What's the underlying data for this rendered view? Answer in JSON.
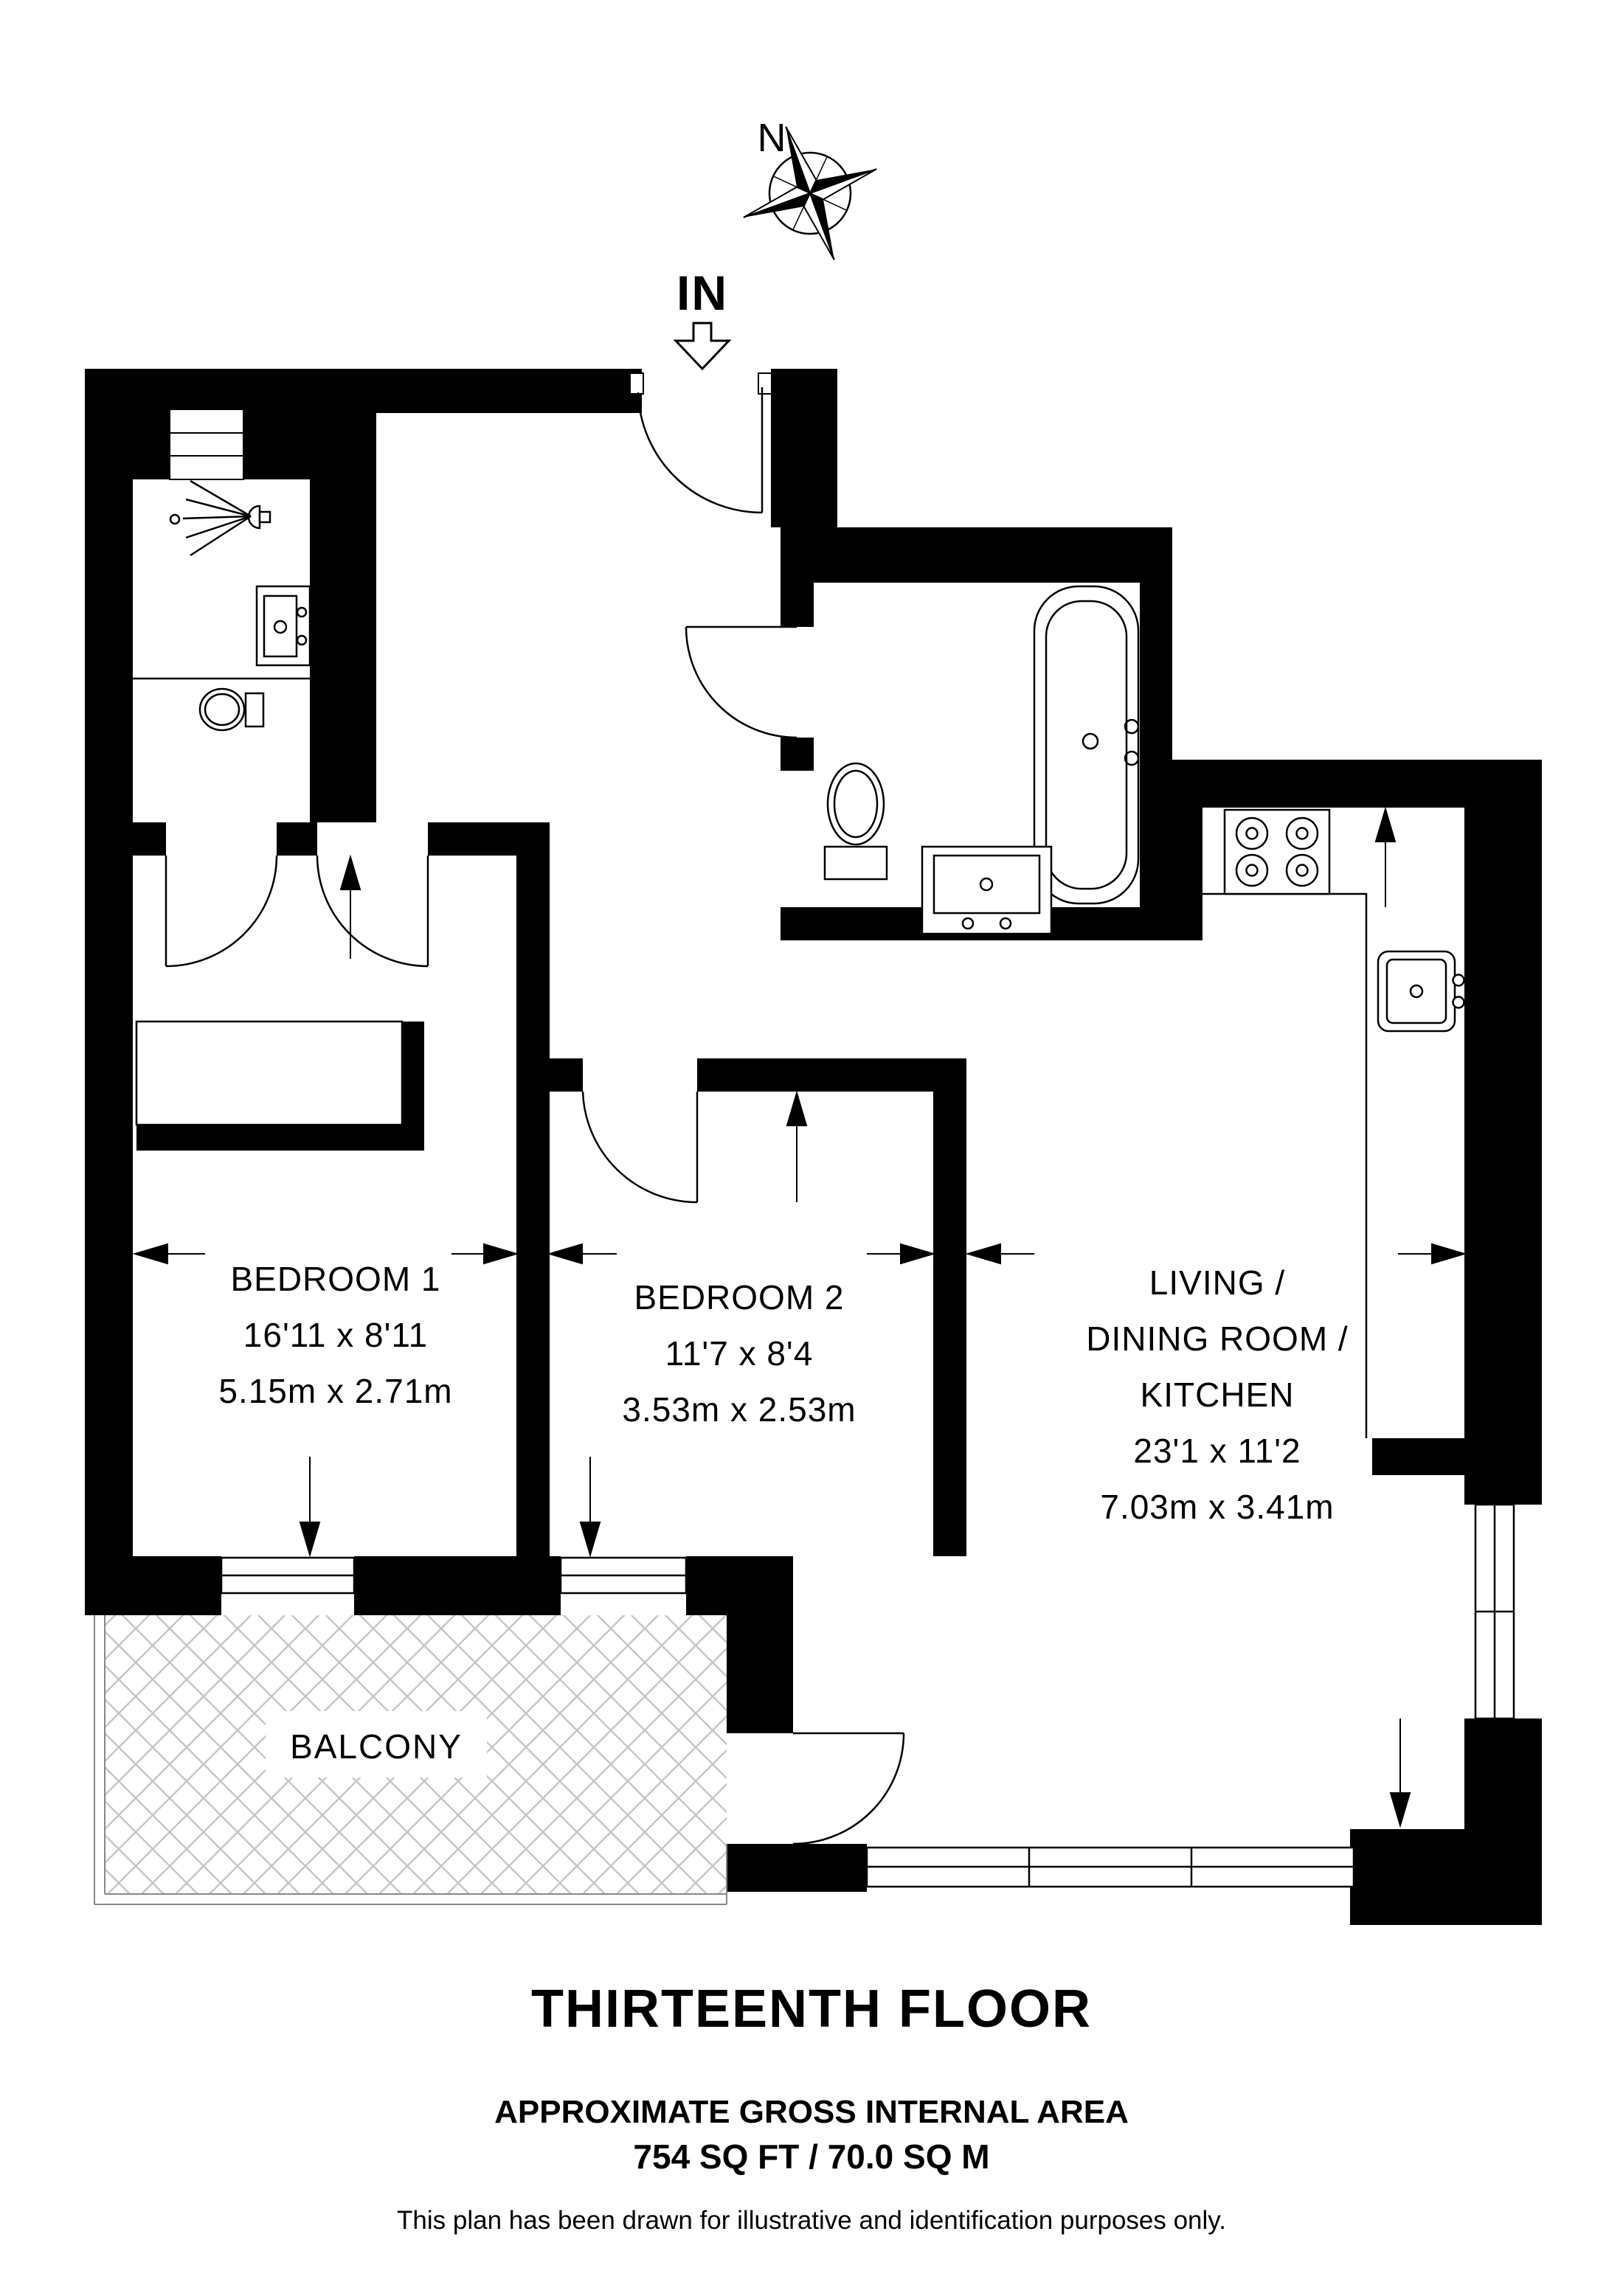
{
  "colors": {
    "wall": "#000000",
    "background": "#ffffff",
    "balcony_hatch": "#c6c6c6",
    "text": "#000000"
  },
  "compass": {
    "north_label": "N"
  },
  "entrance": {
    "in_label": "IN"
  },
  "rooms": {
    "bedroom1": {
      "name": "BEDROOM 1",
      "dims_imperial": "16'11 x 8'11",
      "dims_metric": "5.15m x 2.71m"
    },
    "bedroom2": {
      "name": "BEDROOM 2",
      "dims_imperial": "11'7 x 8'4",
      "dims_metric": "3.53m x 2.53m"
    },
    "living": {
      "name_line1": "LIVING /",
      "name_line2": "DINING ROOM /",
      "name_line3": "KITCHEN",
      "dims_imperial": "23'1 x 11'2",
      "dims_metric": "7.03m x 3.41m"
    },
    "balcony": {
      "name": "BALCONY"
    }
  },
  "fixtures": [
    "compass-rose-icon",
    "entry-arrow-icon",
    "shower-icon",
    "ensuite-basin-icon",
    "ensuite-toilet-icon",
    "wardrobe",
    "bathtub-icon",
    "toilet-icon",
    "basin-icon",
    "hob-icon",
    "kitchen-sink-icon",
    "balcony-hatch"
  ],
  "footer": {
    "floor_title": "THIRTEENTH FLOOR",
    "area_heading": "APPROXIMATE GROSS INTERNAL AREA",
    "area_value": "754 SQ FT / 70.0 SQ M",
    "disclaimer": "This plan has been drawn for illustrative and identification purposes only."
  }
}
